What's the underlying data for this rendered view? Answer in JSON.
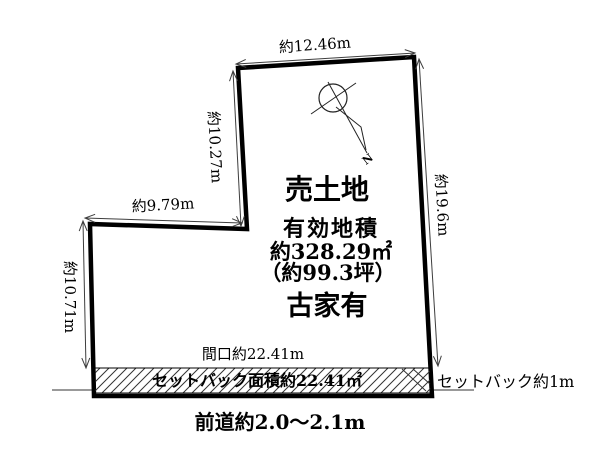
{
  "diagram": {
    "dimensions": {
      "top": "約12.46m",
      "upper_left": "約10.27m",
      "step": "約9.79m",
      "left": "約10.71m",
      "right": "約19.6m"
    },
    "parcel": {
      "title": "売土地",
      "area_label": "有効地積",
      "area_sqm": "約328.29㎡",
      "area_tsubo": "（約99.3坪）",
      "note": "古家有"
    },
    "frontage_label": "間口約22.41m",
    "setback": {
      "strip_label": "セットバック面積約22.41㎡",
      "side_label": "セットバック約1m"
    },
    "front_road_label": "前道約2.0〜2.1m",
    "compass": {
      "north": "N"
    },
    "colors": {
      "outline": "#000000",
      "dimension": "#3d3d3d",
      "road_line": "#999999",
      "background": "#ffffff"
    }
  }
}
